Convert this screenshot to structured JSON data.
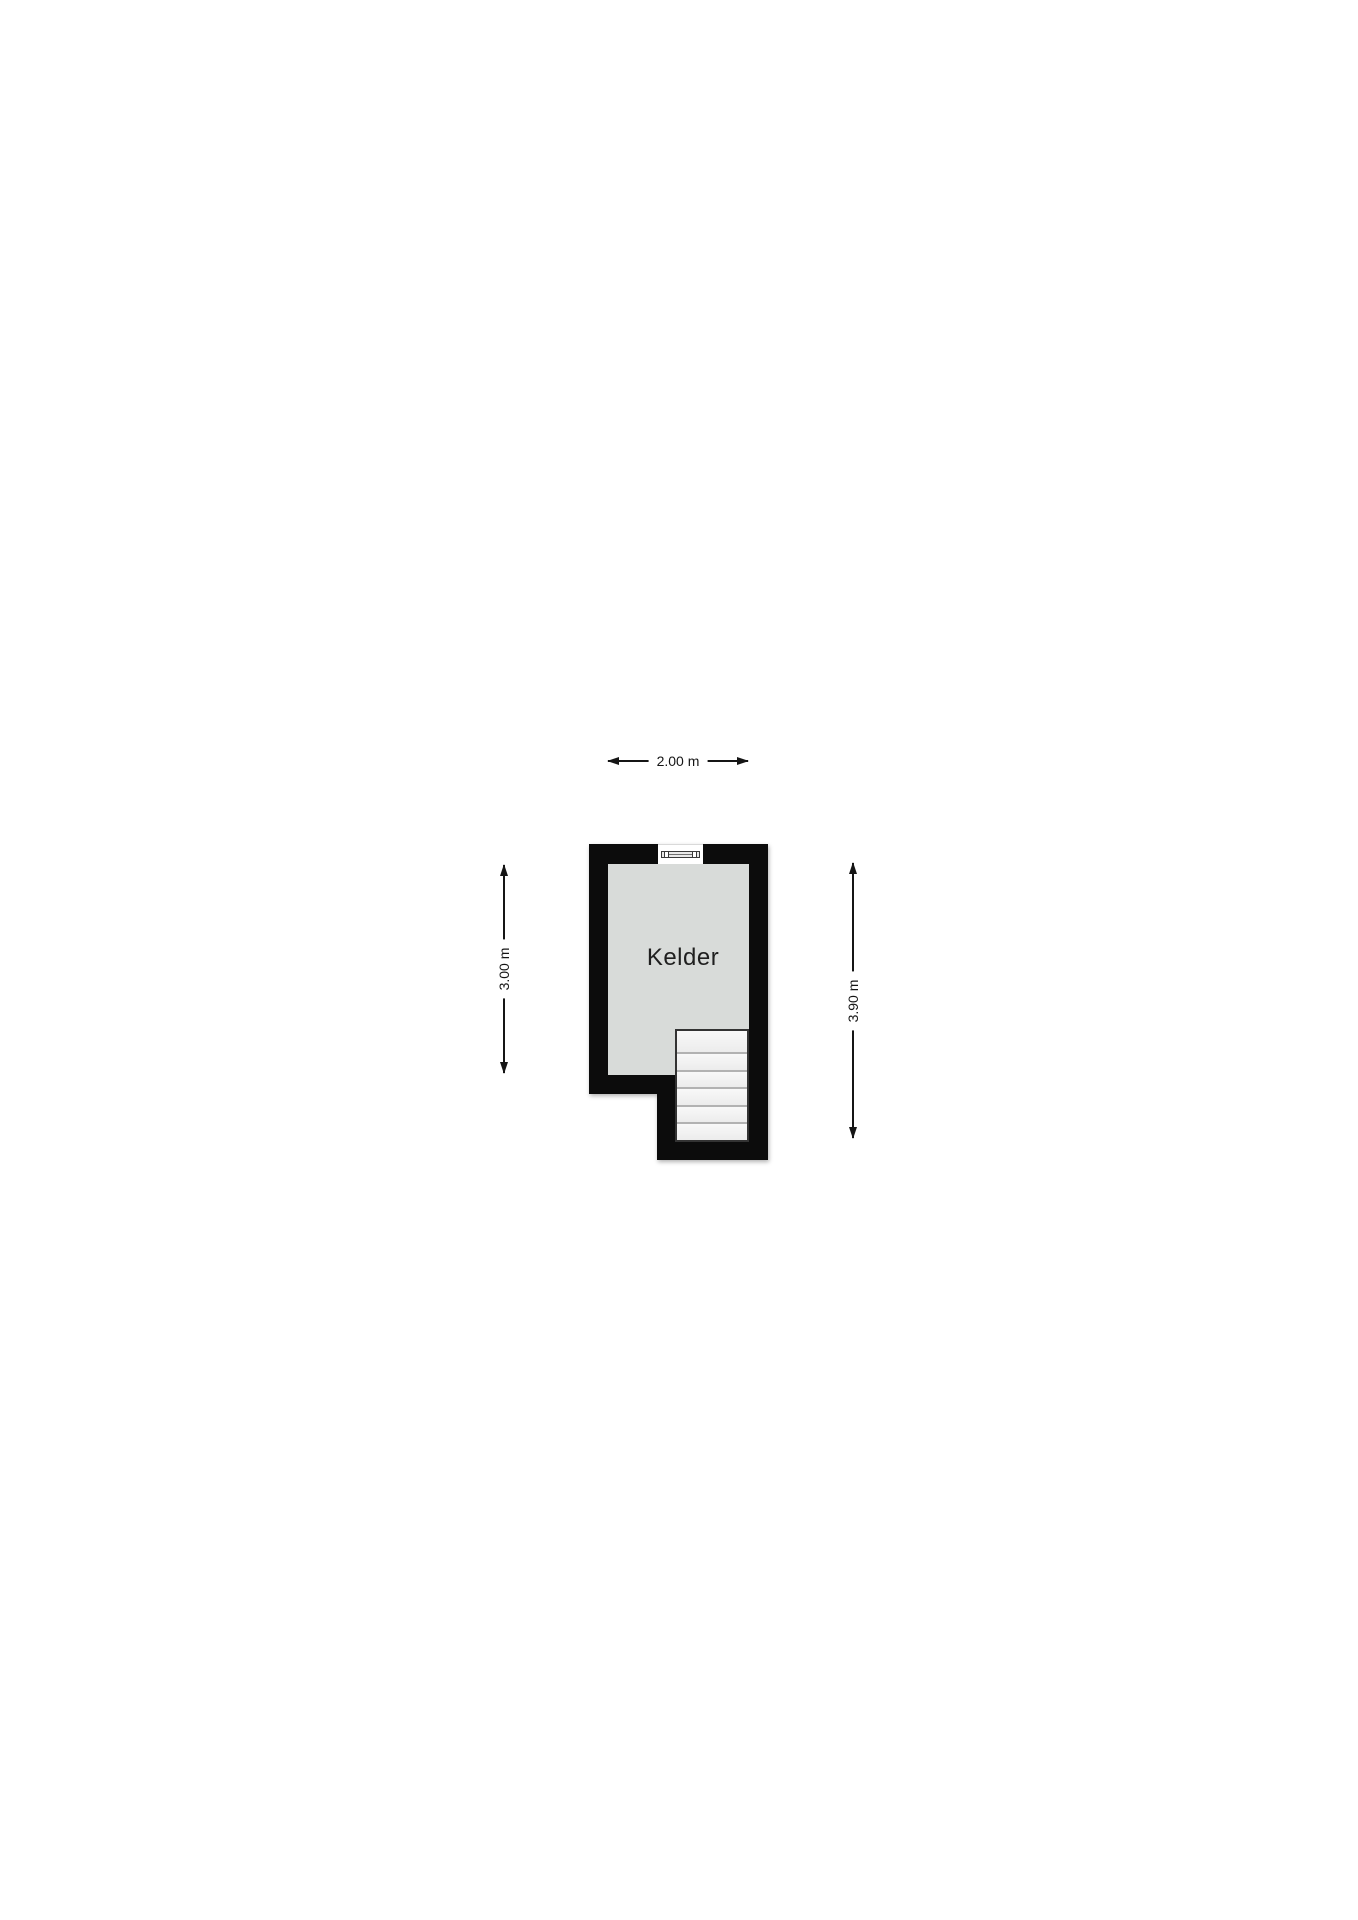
{
  "floorplan": {
    "room": {
      "label": "Kelder"
    },
    "dimensions": {
      "top": "2.00 m",
      "left": "3.00 m",
      "right": "3.90 m"
    },
    "stairs": {
      "treads": 6
    },
    "window": {
      "icon": "window-symbol"
    },
    "colors": {
      "wall": "#0c0c0c",
      "room_fill": "#d8dbd9",
      "stairs_fill": "#f3f3f3",
      "background": "#ffffff"
    }
  }
}
